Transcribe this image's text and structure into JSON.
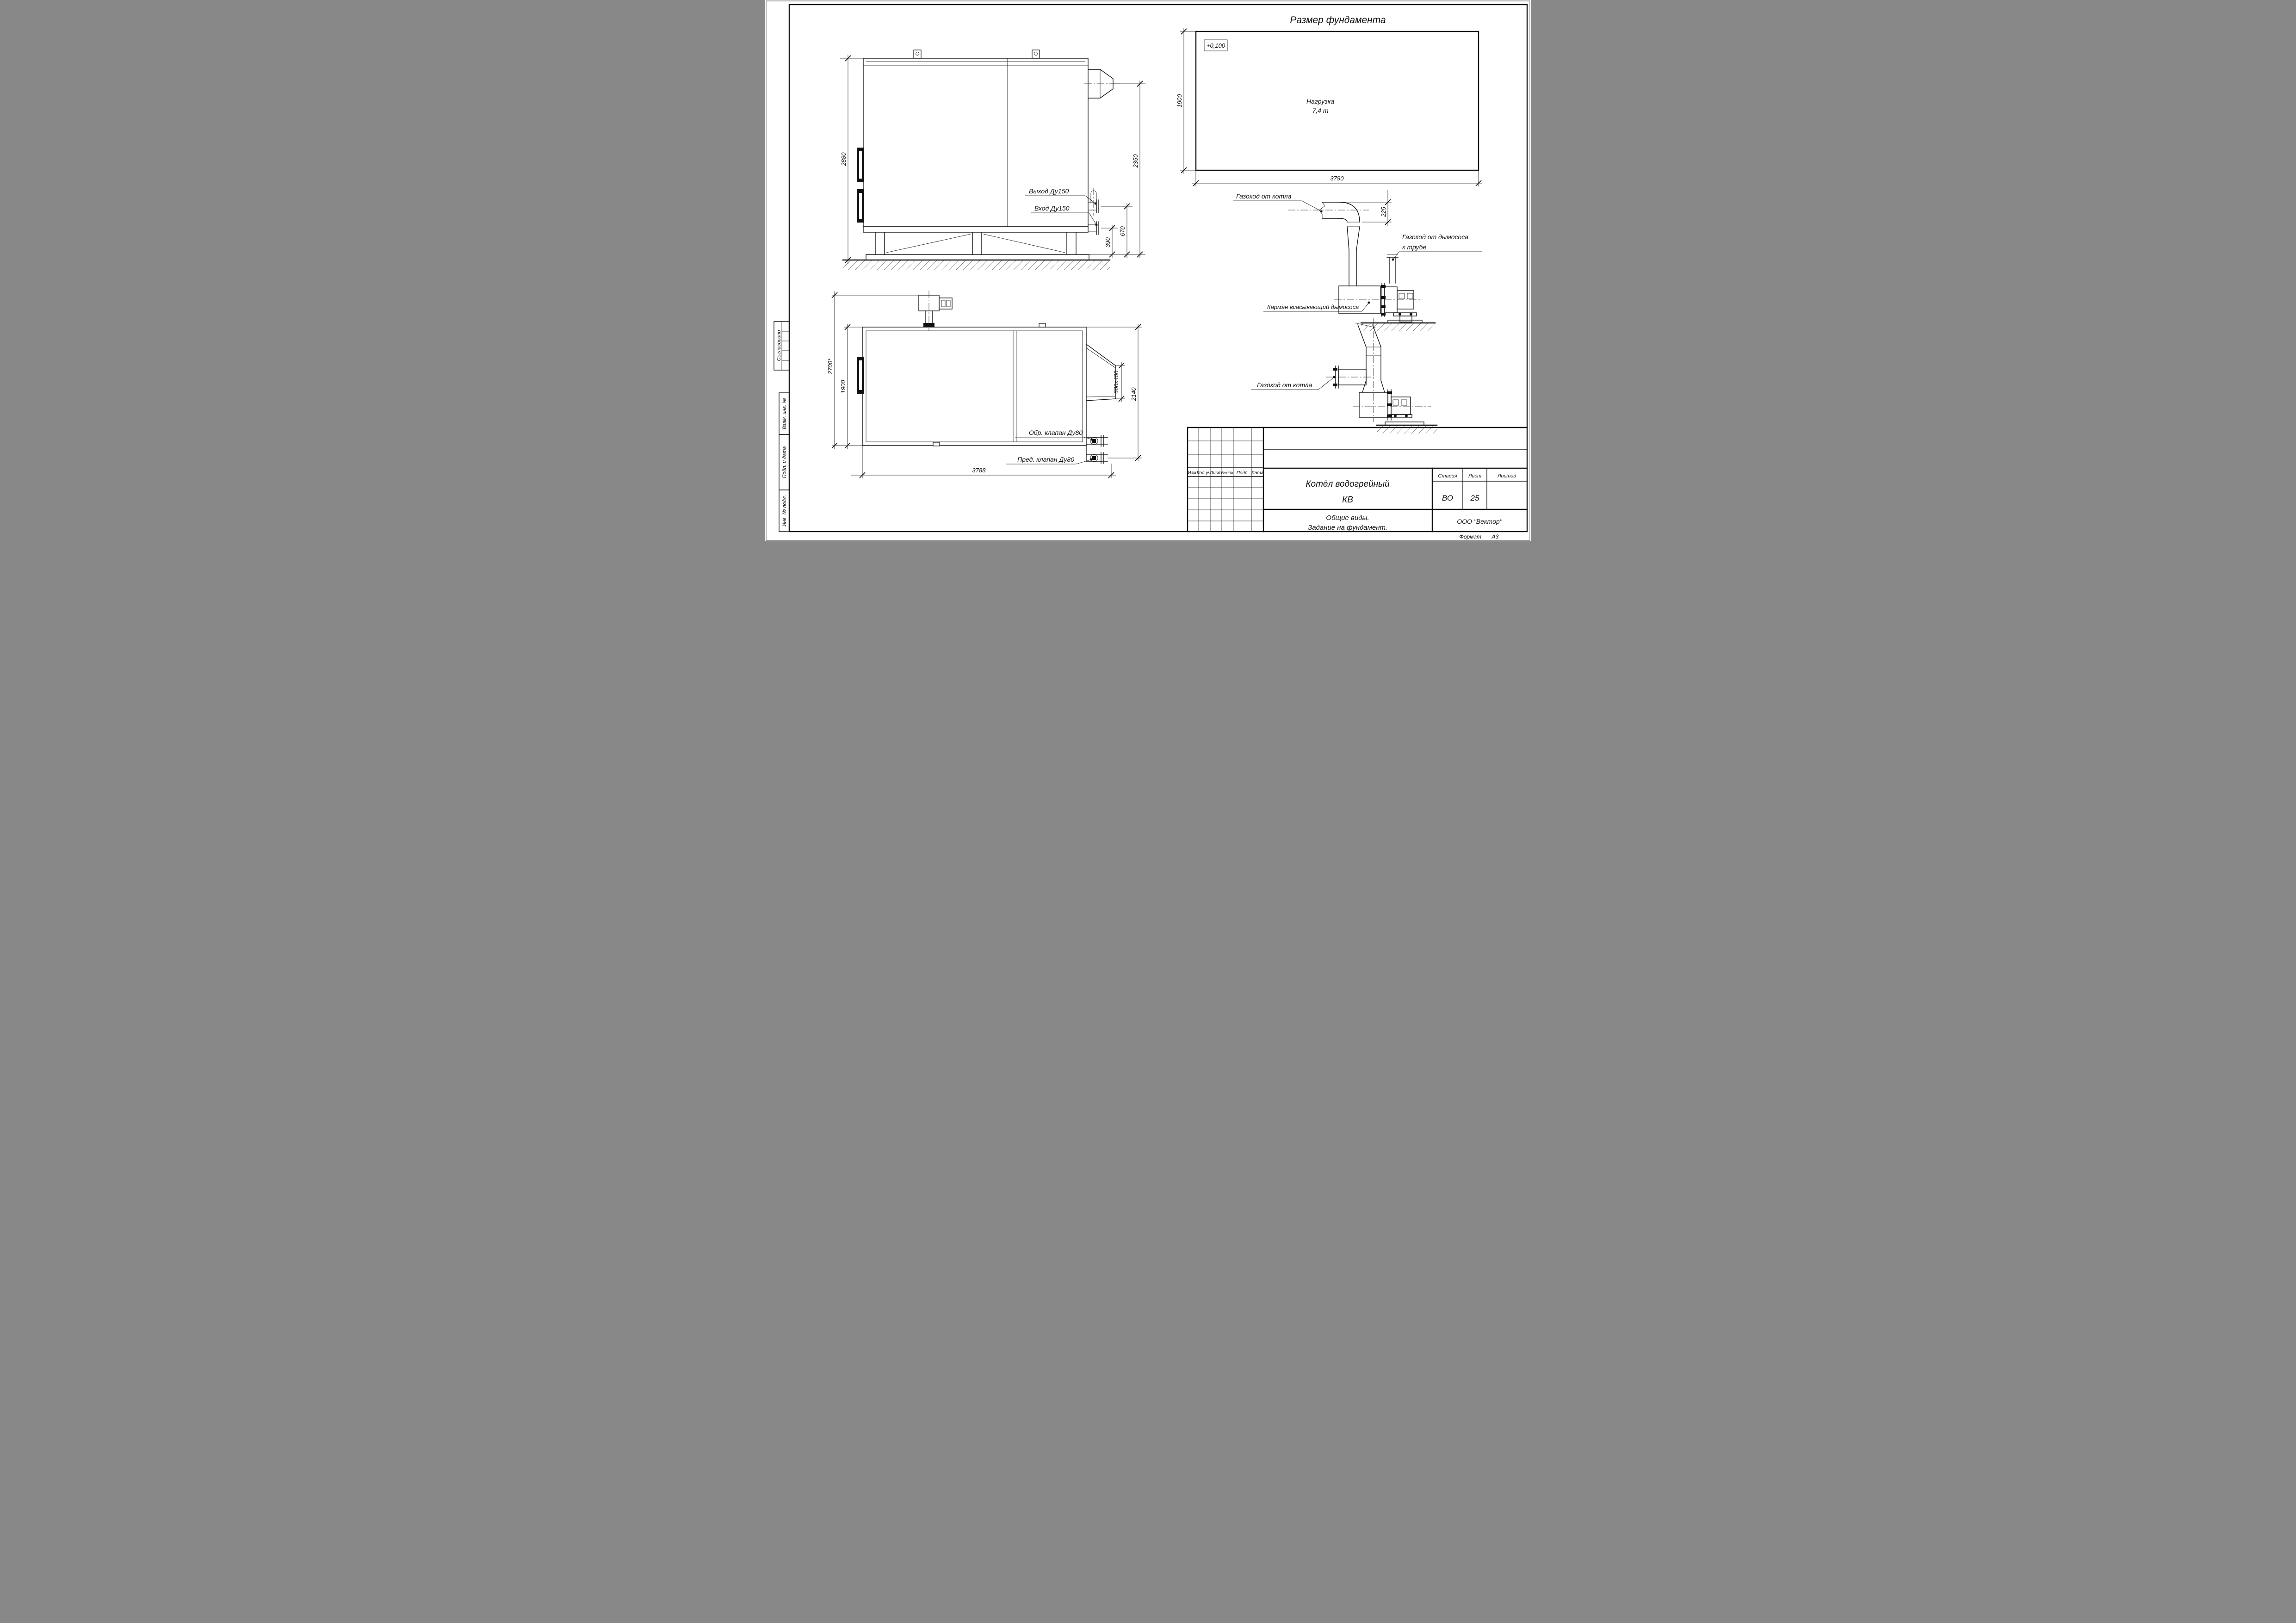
{
  "drawing": {
    "accent_color": "#111111",
    "paper_color": "#ffffff"
  },
  "margin_stamps": {
    "approved": "Согласовано",
    "replace_inv": "Взам. инв. №",
    "sign_date": "Подп. и дата",
    "inv_orig": "Инв. № подл."
  },
  "views": {
    "side_view": {
      "dims": {
        "height_total": "2880",
        "chimney_height": "2350",
        "outlet_height": "670",
        "inlet_height": "390"
      },
      "labels": {
        "outlet": "Выход Ду150",
        "inlet": "Вход Ду150"
      }
    },
    "top_view": {
      "dims": {
        "width_total": "2700*",
        "width_boiler": "1900",
        "duct_size": "600x400",
        "duct_span": "2140",
        "length_total": "3788"
      },
      "labels": {
        "check_valve": "Обр. клапан Ду80",
        "safety_valve": "Пред. клапан Ду80"
      }
    },
    "foundation": {
      "title": "Размер фундамента",
      "elevation": "+0,100",
      "load_line1": "Нагрузка",
      "load_line2": "7,4 т",
      "dims": {
        "width": "1900",
        "length": "3790"
      }
    },
    "duct_view1": {
      "labels": {
        "from_boiler": "Газоход от котла",
        "to_stack_line1": "Газоход от дымососа",
        "to_stack_line2": "к трубе",
        "pocket": "Карман всасывающий дымососа"
      },
      "dims": {
        "offset": "225"
      }
    },
    "duct_view2": {
      "labels": {
        "from_boiler": "Газоход от котла"
      }
    }
  },
  "title_block": {
    "columns": [
      "Изм.",
      "Кол.уч.",
      "Лист",
      "№док.",
      "Подп.",
      "Дата"
    ],
    "doc_title_line1": "Котёл водогрейный",
    "doc_title_line2": "КВ",
    "stage_label": "Стадия",
    "sheet_label": "Лист",
    "sheets_label": "Листов",
    "stage_value": "ВО",
    "sheet_value": "25",
    "sheets_value": "",
    "subtitle_line1": "Общие виды.",
    "subtitle_line2": "Задание на фундамент.",
    "company": "ООО \"Вектор\"",
    "format_label": "Формат",
    "format_value": "А3"
  }
}
